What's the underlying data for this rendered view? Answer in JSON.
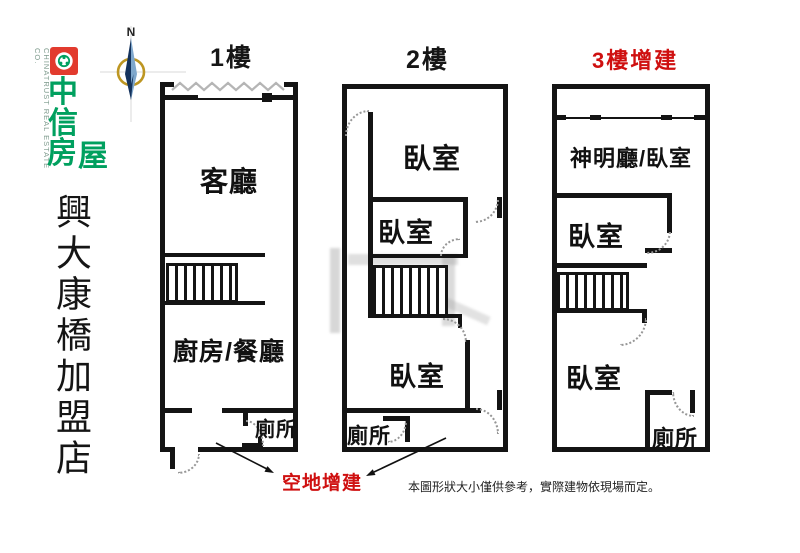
{
  "branding": {
    "company_name": "中信房屋",
    "company_chars": [
      "中",
      "信",
      "房",
      "屋"
    ],
    "company_name_en": "CHINATRUST REAL ESTATE CO.",
    "store_name": "興大康橋加盟店",
    "logo_red": "#e23b2e",
    "logo_green": "#00a05f"
  },
  "compass": {
    "north_label": "N"
  },
  "floors": [
    {
      "title": "1樓",
      "rooms": {
        "living": "客廳",
        "kitchen_dining": "廚房/餐廳",
        "toilet": "廁所"
      }
    },
    {
      "title": "2樓",
      "rooms": {
        "bedroom_top": "臥室",
        "bedroom_mid": "臥室",
        "bedroom_low": "臥室",
        "toilet": "廁所"
      }
    },
    {
      "title": "3樓增建",
      "rooms": {
        "shrine_bedroom": "神明廳/臥室",
        "bedroom_mid": "臥室",
        "bedroom_low": "臥室",
        "toilet": "廁所"
      }
    }
  ],
  "annotations": {
    "vacant_land_addition": "空地增建",
    "disclaimer": "本圖形狀大小僅供參考，實際建物依現場而定。",
    "red_accent": "#cf1010"
  }
}
